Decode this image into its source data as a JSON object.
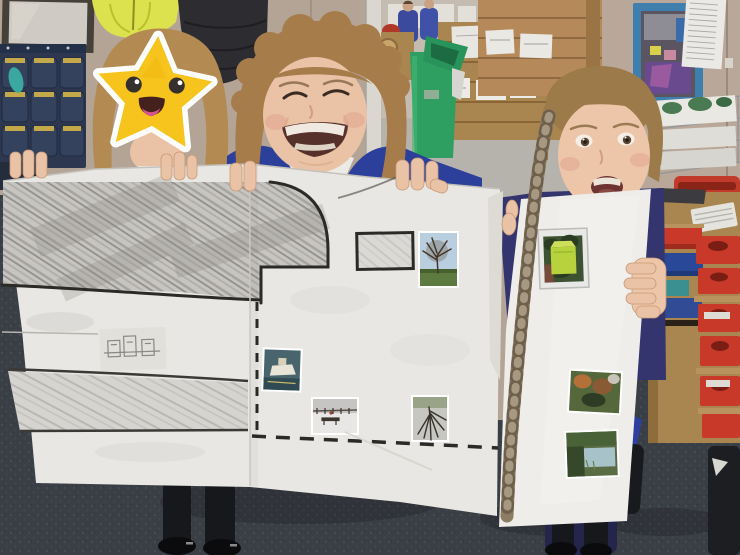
{
  "scene": {
    "setting": "primary-school classroom",
    "subject": "three pupils holding a large hand-drawn map poster with photo cut-outs",
    "privacy": "first child's face covered by a smiling star emoji"
  },
  "poster": {
    "sheets": 3,
    "drawn_features": [
      "large pencil-shaded area with curved black boundary",
      "quarter-circle arc outline",
      "building outline rectangle",
      "double-line shaded road band",
      "dashed footpath lines",
      "small card with pencil house sketches"
    ],
    "photos": [
      "bare winter tree in field",
      "boat on water",
      "snowy bench and fence",
      "tree reflected in icy puddle",
      "yellow-green grit bin in hedge",
      "autumn shrubs",
      "garden pond"
    ]
  },
  "background_items": [
    "framed board",
    "hi-vis jacket",
    "dark coat",
    "hanging pocket organizer",
    "green pedal bin",
    "wooden pallet shelving with books",
    "blue-framed window",
    "white list paper",
    "wire paper-tray rack",
    "red basket",
    "tray storage unit with red and blue trays",
    "computer keyboard"
  ],
  "colors": {
    "wall": "#b4a496",
    "wall_right": "#b9a899",
    "back_wall": "#c4bcb0",
    "back_floor": "#b6b2ac",
    "door_frame": "#dad7d1",
    "carpet": "#3a3f46",
    "poster_paper": "#e9e7e3",
    "sheet_paper": "#eeede9",
    "ink": "#2b2a27",
    "pencil_line": "#3b3a37",
    "star": "#f6c41d",
    "star_shade": "#eeb30c",
    "star_border": "#ffffff",
    "star_eye": "#35302e",
    "star_mouth": "#45211d",
    "star_tongue": "#d4548c",
    "hair_left": "#b28a52",
    "hair_mid": "#a77c4b",
    "hair_girl": "#9c7a4a",
    "braid": "#8d7c64",
    "skin": "#eac2a6",
    "skin_girl": "#edc5a9",
    "blush": "#dfa08a",
    "cardigan": "#2c3f9a",
    "jumper": "#34356e",
    "sleeve": "#2e3e9e",
    "polo": "#eceae6",
    "bin_green": "#2f9e61",
    "bin_lid": "#28935a",
    "hi_vis": "#dce24e",
    "puffer": "#2c2c31",
    "organizer": "#2d3850",
    "pocket": "#35425e",
    "pocket_trim": "#d4b54a",
    "teal_item": "#3aa8a0",
    "window_blue": "#3f7fae",
    "window_inner": "#5a5560",
    "purple_tray": "#6a4a8e",
    "tray_red": "#c8392a",
    "tray_blue": "#2a4898",
    "tray_teal": "#3a9090",
    "wood": "#a9854f",
    "wood_light": "#b5895a",
    "basket_red": "#c23a2a",
    "keyboard": "#e5e3de",
    "paper_white": "#eae9e5",
    "legs": "#17181c",
    "shoes": "#0b0b0d",
    "photo_sky": "#b9cfe0",
    "photo_grass": "#5d7a40",
    "grit_green": "#b8d23e",
    "snow": "#e8e7e5",
    "water": "#a8c2ca"
  }
}
